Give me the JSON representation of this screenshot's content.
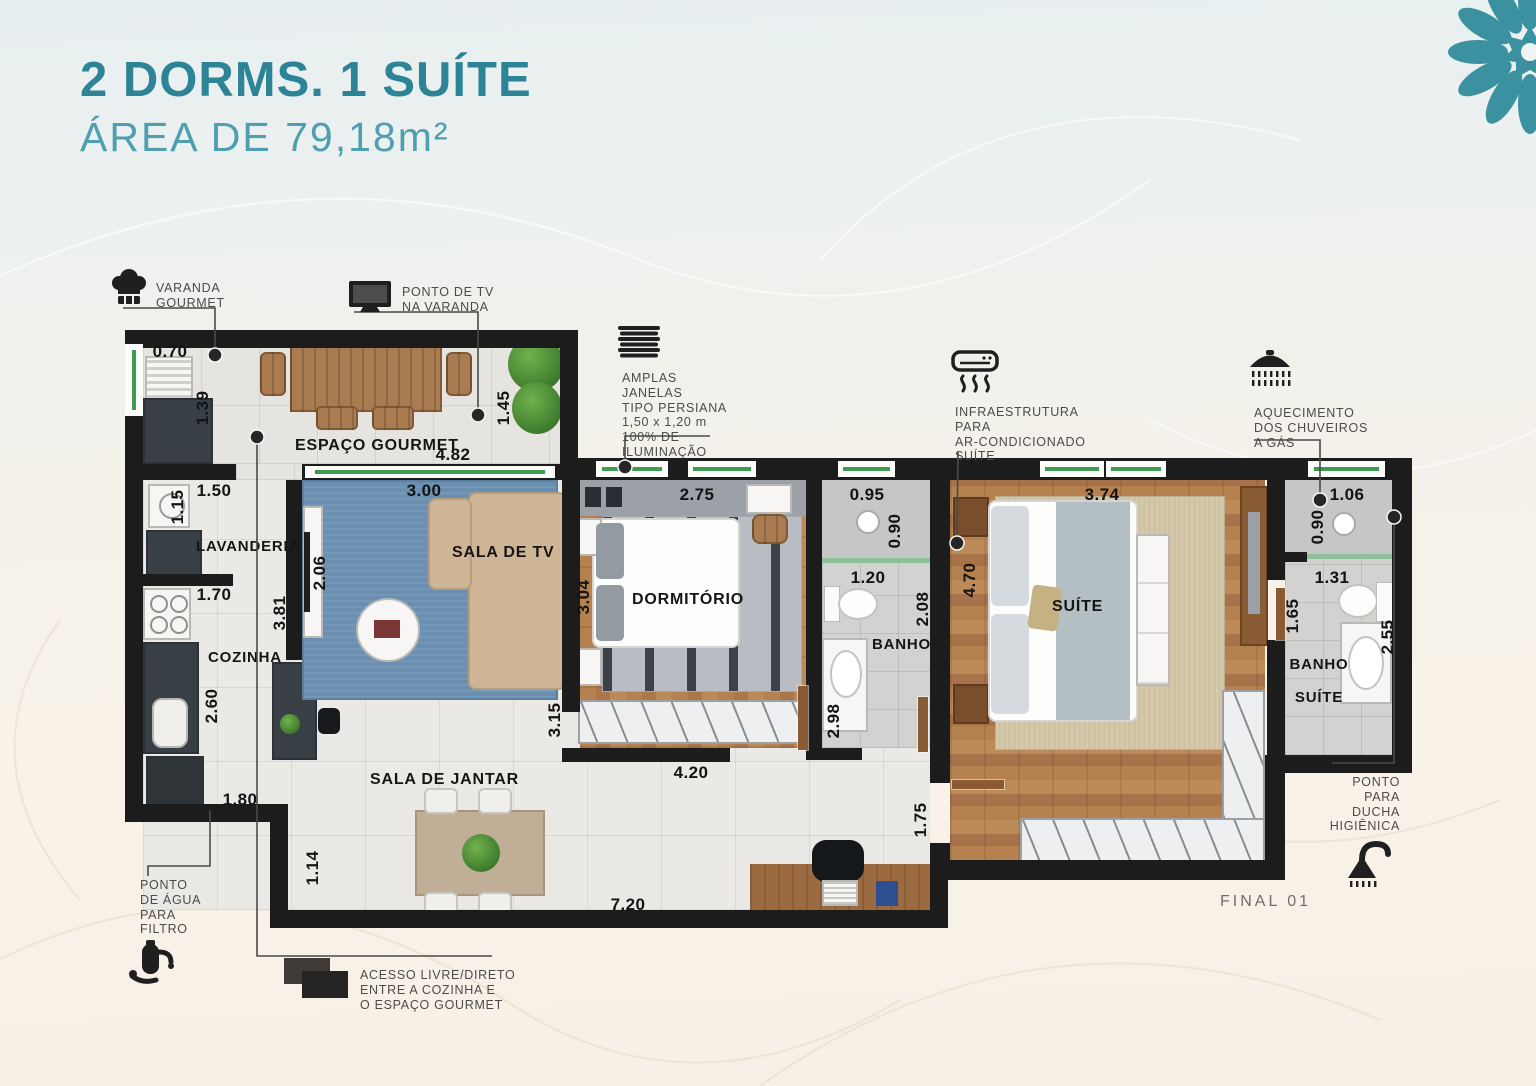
{
  "header": {
    "title": "2 DORMS. 1 SUÍTE",
    "subtitle": "ÁREA DE 79,18m²"
  },
  "colors": {
    "accent_teal": "#2d8496",
    "logo_teal": "#3b91a0",
    "wall": "#1c1c1c",
    "wood_floor": "#b07c4e",
    "window_sill_green": "#3e9b52",
    "rug_blue": "#6b8fb0"
  },
  "rooms": {
    "espaco_gourmet": "ESPAÇO GOURMET",
    "lavanderia": "LAVANDERIA",
    "cozinha": "COZINHA",
    "sala_tv": "SALA DE TV",
    "sala_jantar": "SALA DE JANTAR",
    "dormitorio": "DORMITÓRIO",
    "banho": "BANHO",
    "suite": "SUÍTE",
    "banho_suite_1": "BANHO",
    "banho_suite_2": "SUÍTE"
  },
  "dims": {
    "v070": "0.70",
    "v139": "1.39",
    "v150": "1.50",
    "v115": "1.15",
    "v170": "1.70",
    "v381": "3.81",
    "v206": "2.06",
    "v260": "2.60",
    "v180": "1.80",
    "v300": "3.00",
    "v482": "4.82",
    "v145": "1.45",
    "v304": "3.04",
    "v275": "2.75",
    "v315": "3.15",
    "v420": "4.20",
    "v720": "7.20",
    "v114": "1.14",
    "v175": "1.75",
    "v095": "0.95",
    "v090a": "0.90",
    "v120": "1.20",
    "v208": "2.08",
    "v298": "2.98",
    "v374": "3.74",
    "v470": "4.70",
    "v106": "1.06",
    "v090b": "0.90",
    "v131": "1.31",
    "v165": "1.65",
    "v255": "2.55"
  },
  "callouts": {
    "varanda_gourmet": {
      "lines": [
        "VARANDA",
        "GOURMET"
      ]
    },
    "ponto_tv": {
      "lines": [
        "PONTO DE TV",
        "NA VARANDA"
      ]
    },
    "amplas_janelas": {
      "lines": [
        "AMPLAS",
        "JANELAS",
        "TIPO PERSIANA",
        "1,50 x 1,20 m",
        "100% DE",
        "ILUMINAÇÃO"
      ]
    },
    "infra_ar": {
      "lines": [
        "INFRAESTRUTURA",
        "PARA",
        "AR-CONDICIONADO",
        "SUÍTE"
      ]
    },
    "aquecimento": {
      "lines": [
        "AQUECIMENTO",
        "DOS CHUVEIROS",
        "A GÁS"
      ]
    },
    "ducha": {
      "lines": [
        "PONTO",
        "PARA",
        "DUCHA",
        "HIGIÊNICA"
      ]
    },
    "agua_filtro": {
      "lines": [
        "PONTO",
        "DE ÁGUA",
        "PARA",
        "FILTRO"
      ]
    },
    "acesso": {
      "lines": [
        "ACESSO LIVRE/DIRETO",
        "ENTRE A COZINHA E",
        "O ESPAÇO GOURMET"
      ]
    }
  },
  "footer": {
    "final": "FINAL 01"
  }
}
